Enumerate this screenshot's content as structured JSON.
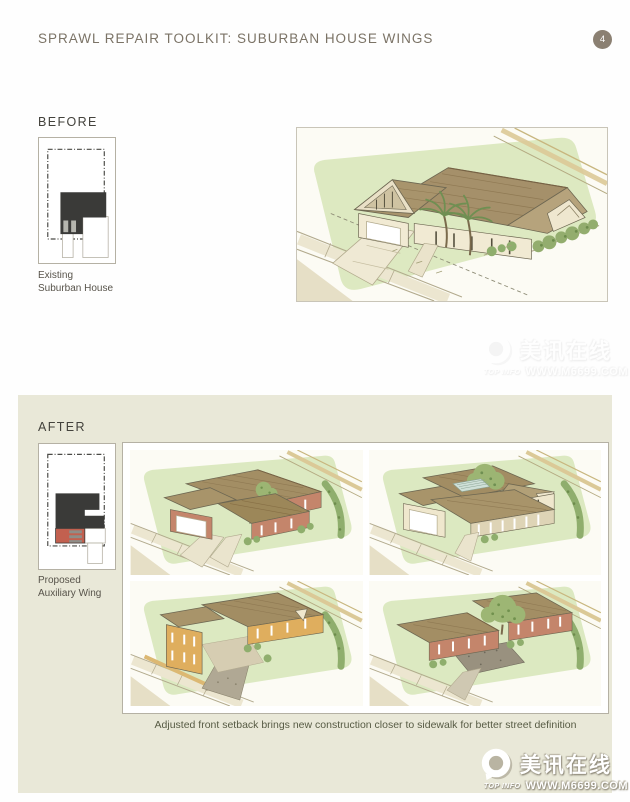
{
  "header": {
    "title": "SPRAWL REPAIR TOOLKIT:  SUBURBAN HOUSE WINGS",
    "page_number": "4"
  },
  "before": {
    "label": "BEFORE",
    "plan_caption_line1": "Existing",
    "plan_caption_line2": "Suburban House"
  },
  "after": {
    "label": "AFTER",
    "plan_caption_line1": "Proposed",
    "plan_caption_line2": "Auxiliary Wing",
    "caption": "Adjusted front setback brings new construction closer to sidewalk for better street definition"
  },
  "watermark": {
    "brand": "美讯在线",
    "badge": "TOP INFO",
    "url": "WWW.M6699.COM"
  },
  "palette": {
    "page_bg": "#fefefe",
    "header_text": "#7b7366",
    "badge_bg": "#8b8072",
    "label_text": "#43423c",
    "caption_text": "#57534a",
    "panel_bg": "#e9e8d8",
    "box_border": "#b5b1a4",
    "after_caption": "#575b44",
    "footprint": "#3a3a38",
    "wing_red": "#c2604f",
    "wing_stripe": "#8e8e88",
    "lawn_green": "#dde9c1",
    "roof_tan": "#a5906a",
    "wall_cream": "#f1ead3",
    "wall_brick": "#c4856b",
    "wall_ochre": "#dfae5e"
  }
}
